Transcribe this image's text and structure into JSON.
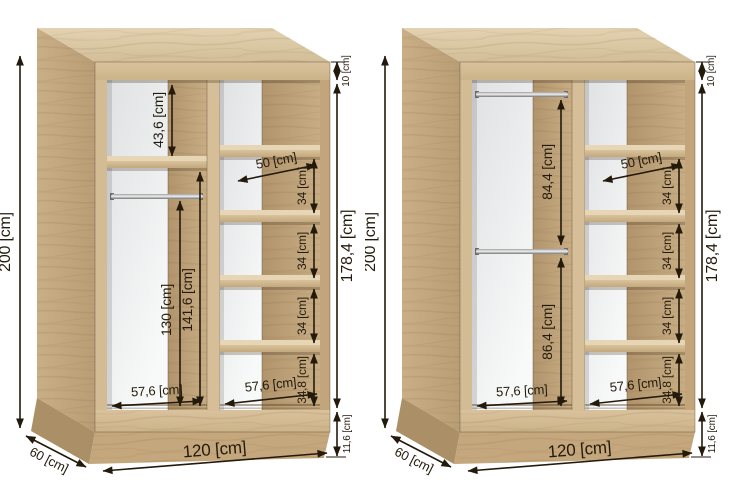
{
  "lw": {
    "height": "200 [cm]",
    "top_gap": "10 [cm]",
    "interior_height": "178,4 [cm]",
    "plinth": "11,6 [cm]",
    "width": "120 [cm]",
    "depth": "60 [cm]",
    "top_section": "43,6 [cm]",
    "rail_drop": "130 [cm]",
    "under_shelf": "141,6 [cm]",
    "shelf_width": "50 [cm]",
    "shelf_gap": "34 [cm]",
    "bottom_gap": "34,8 [cm]",
    "col_width": "57,6 [cm]"
  },
  "rw": {
    "height": "200 [cm]",
    "top_gap": "10 [cm]",
    "interior_height": "178,4 [cm]",
    "plinth": "11,6 [cm]",
    "width": "120 [cm]",
    "depth": "60 [cm]",
    "upper_section": "84,4 [cm]",
    "lower_section": "86,4 [cm]",
    "shelf_width": "50 [cm]",
    "shelf_gap": "34 [cm]",
    "bottom_gap": "34,8 [cm]",
    "col_width": "57,6 [cm]"
  },
  "colors": {
    "wood_front": "#d6bf99",
    "wood_side": "#c2a67e",
    "wood_top": "#dccaa8",
    "wood_inner": "#b89c74",
    "back_panel": "#eef0f1",
    "dimension_ink": "#231a0c",
    "rail_metal": "#a7a7a7",
    "background": "#ffffff"
  }
}
